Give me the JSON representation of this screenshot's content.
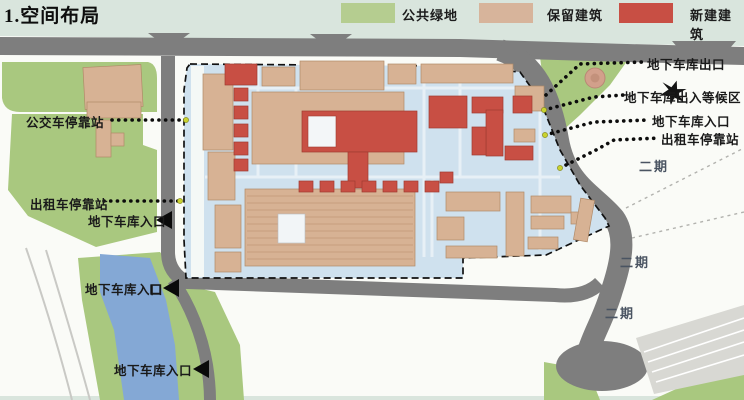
{
  "title": "1.空间布局",
  "legend": {
    "items": [
      {
        "label": "公共绿地",
        "color": "#b5cd90"
      },
      {
        "label": "保留建筑",
        "color": "#d7b49b"
      },
      {
        "label": "新建建筑",
        "color": "#c84f44"
      }
    ]
  },
  "map": {
    "labels": {
      "bus_stop_left": "公交车停靠站",
      "taxi_stop_left": "出租车停靠站",
      "garage_entrance_left_1": "地下车库入口",
      "garage_entrance_left_2": "地下车库入口",
      "garage_entrance_bottom": "地下车库入口",
      "garage_exit_right": "地下车库出口",
      "garage_waiting_area": "地下车库出入等候区",
      "garage_entrance_right": "地下车库入口",
      "taxi_stop_right": "出租车停靠站",
      "phase2": [
        "二期",
        "二期",
        "二期"
      ]
    },
    "colors": {
      "bg": "#d9e5dd",
      "map_bg": "#fafbf7",
      "road": "#7e7e7e",
      "green": "#a9c87f",
      "river": "#84a8d5",
      "site": "#cfe1ee",
      "site_border": "#111111",
      "retained": "#d7b294",
      "retained_border": "#b08a68",
      "new": "#c84f44",
      "new_border": "#9e3b31",
      "bridge": "#d8d8d3",
      "tree": "#d2a08b",
      "label": "#1a1a1a",
      "phase": "#4a5462",
      "dot_yellow": "#c9d22f"
    }
  }
}
